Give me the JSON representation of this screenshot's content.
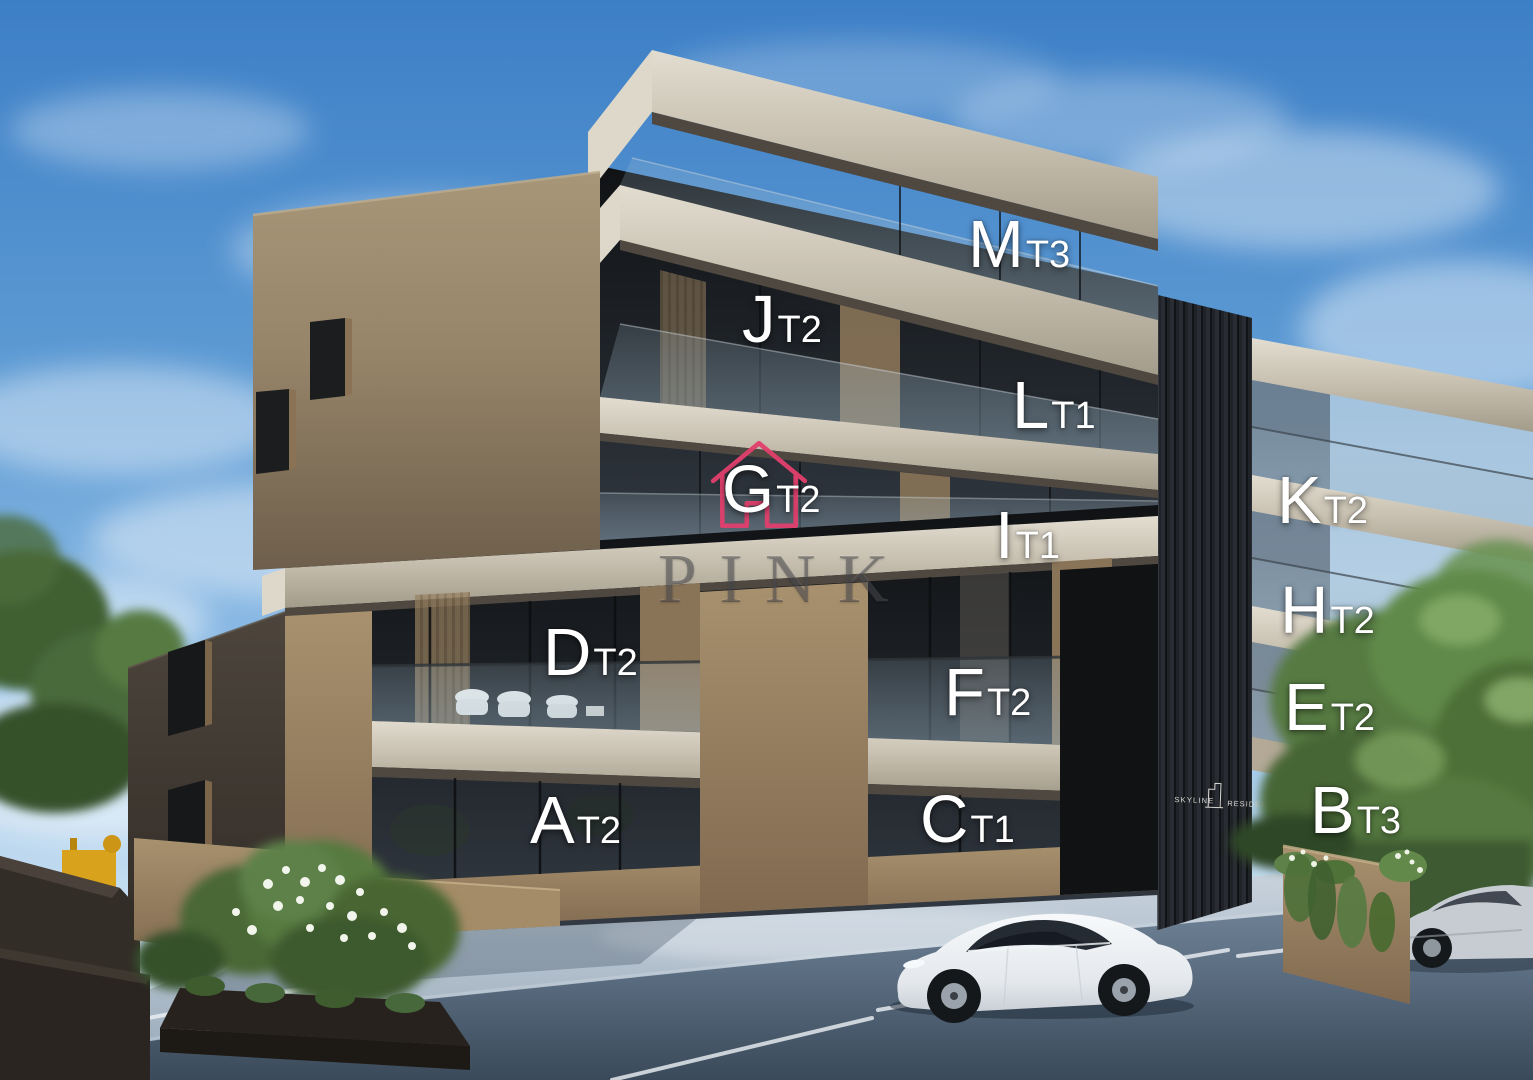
{
  "watermark": {
    "text": "PINK"
  },
  "sign": {
    "line1": "SKYLINE",
    "line2": "RESIDENCE"
  },
  "units": {
    "a": {
      "letter": "A",
      "type": "T2"
    },
    "b": {
      "letter": "B",
      "type": "T3"
    },
    "c": {
      "letter": "C",
      "type": "T1"
    },
    "d": {
      "letter": "D",
      "type": "T2"
    },
    "e": {
      "letter": "E",
      "type": "T2"
    },
    "f": {
      "letter": "F",
      "type": "T2"
    },
    "g": {
      "letter": "G",
      "type": "T2"
    },
    "h": {
      "letter": "H",
      "type": "T2"
    },
    "i": {
      "letter": "I",
      "type": "T1"
    },
    "j": {
      "letter": "J",
      "type": "T2"
    },
    "k": {
      "letter": "K",
      "type": "T2"
    },
    "l": {
      "letter": "L",
      "type": "T1"
    },
    "m": {
      "letter": "M",
      "type": "T3"
    }
  },
  "palette": {
    "sky_top": "#3d7fc6",
    "concrete_light": "#d9d3c6",
    "facade_tan": "#8a7458",
    "glass_dark": "#1a1e23",
    "core_dark": "#24272c",
    "brand_pink": "#e23f6d",
    "foliage_green": "#55793f",
    "road_grey": "#46566a",
    "label_white": "#ffffff"
  }
}
